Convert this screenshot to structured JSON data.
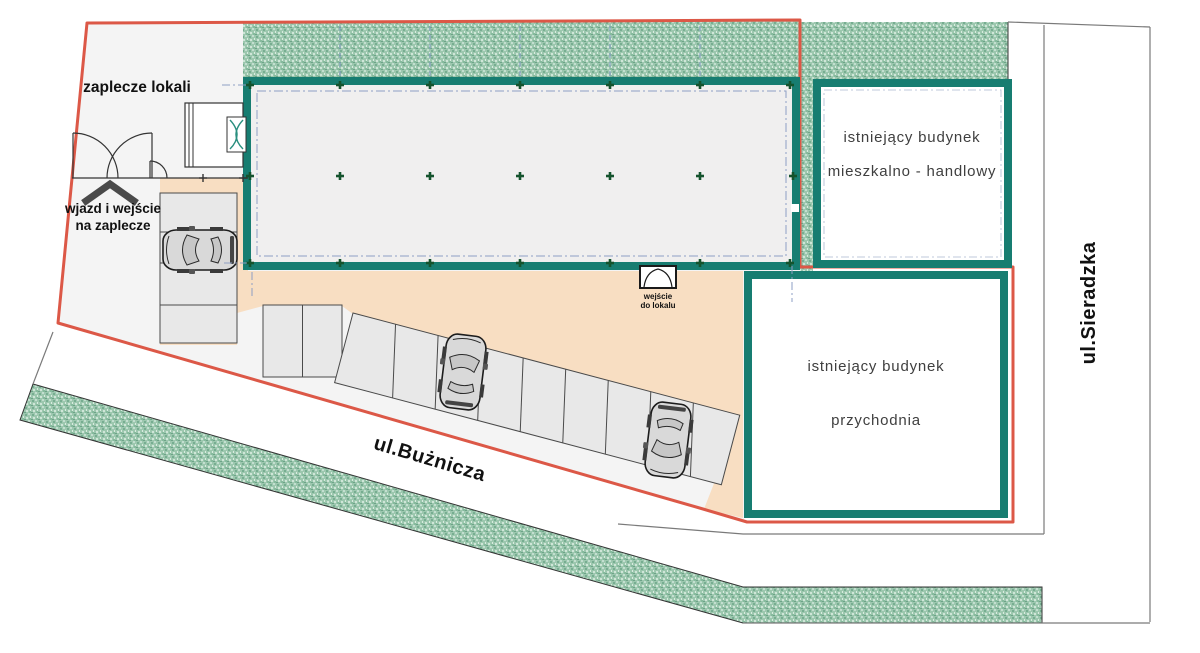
{
  "plan": {
    "title": "site plan",
    "labels": {
      "zaplecze": "zaplecze lokali",
      "wjazd_line1": "wjazd i wejście",
      "wjazd_line2": "na zaplecze",
      "wejscie_line1": "wejście",
      "wejscie_line2": "do lokalu",
      "building_residential_line1": "istniejący budynek",
      "building_residential_line2": "mieszkalno - handlowy",
      "building_clinic_line1": "istniejący budynek",
      "building_clinic_line2": "przychodnia",
      "street_bottom": "ul.Bużnicza",
      "street_right": "ul.Sieradzka"
    },
    "colors": {
      "boundary_red": "#dc5847",
      "wall_teal": "#177d71",
      "hatch_green_base": "#9cc7ae",
      "yard_orange": "#f8dec2",
      "site_gray": "#f4f4f4",
      "stall_gray": "#e8e8e8",
      "axis_blue": "#8e9fc4",
      "column_green": "#14532d",
      "floor_gray": "#f0efef"
    }
  }
}
